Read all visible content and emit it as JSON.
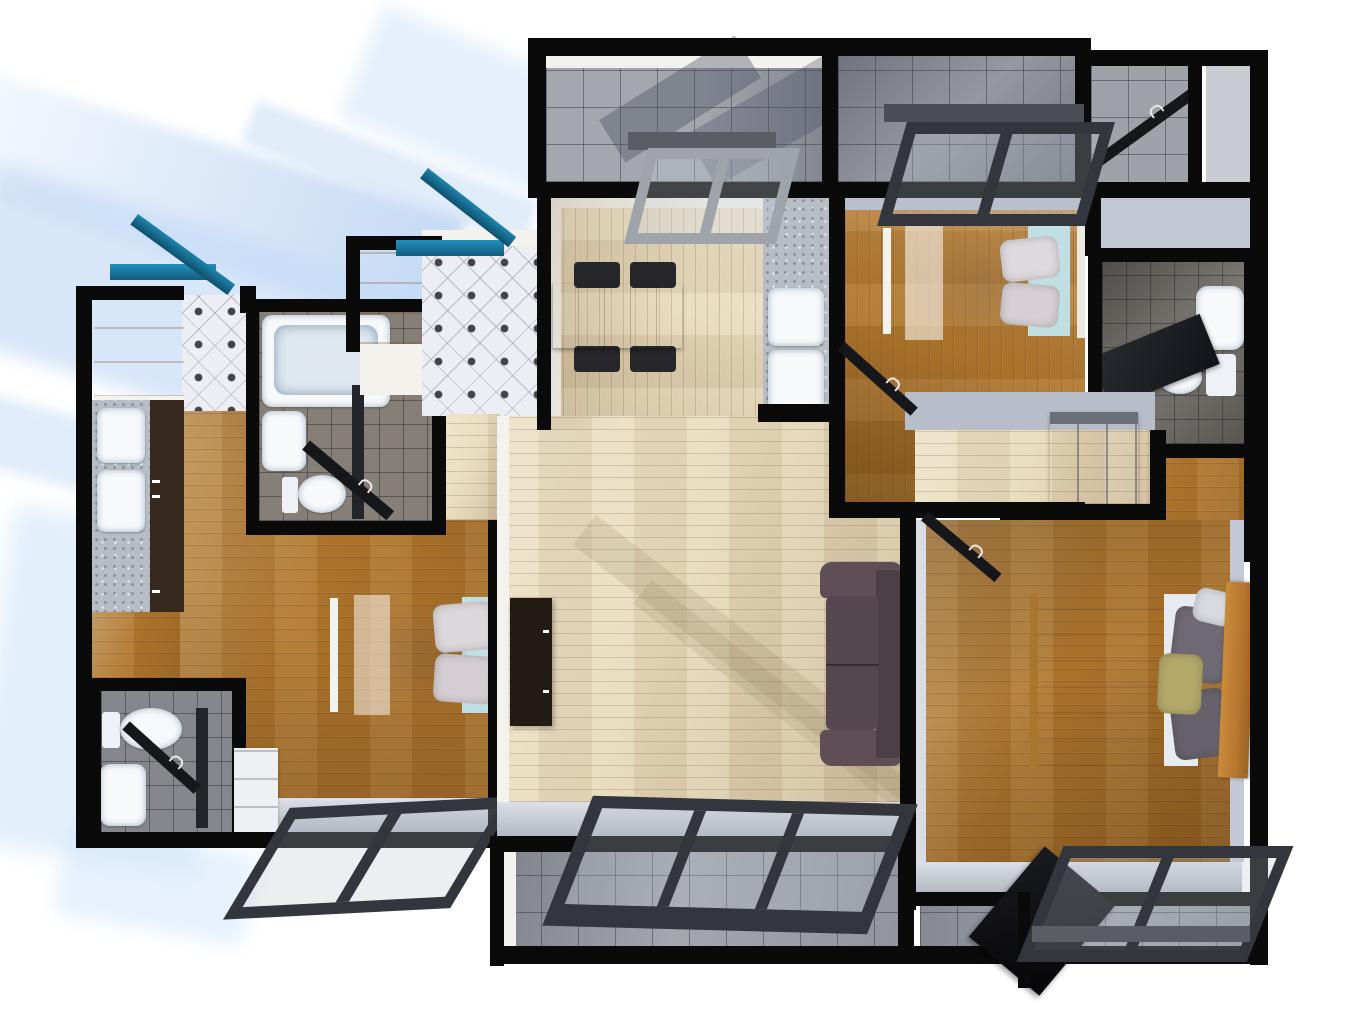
{
  "scene": {
    "type": "3d_floor_plan_render",
    "view": "top_down",
    "style": "photorealistic architectural render on white background with soft blue cast shadows falling to the lower-left",
    "units": [
      {
        "name": "Studio unit (left)",
        "rooms": [
          {
            "name": "Entry foyer",
            "floor": "white diamond tile",
            "items": [
              "teal entry door (open)",
              "wood wardrobe"
            ]
          },
          {
            "name": "Kitchenette",
            "floor": "hardwood",
            "items": [
              "stone counter",
              "double sink",
              "dark cabinet run"
            ]
          },
          {
            "name": "Bathroom",
            "floor": "gray tile",
            "items": [
              "bathtub",
              "wash basin",
              "toilet",
              "dark swing door (open)"
            ]
          },
          {
            "name": "Sleeping area",
            "floor": "hardwood",
            "items": [
              "single bed with blush bedding",
              "two gray pillows",
              "teal bed base"
            ]
          },
          {
            "name": "Water closet",
            "floor": "gray tile",
            "items": [
              "toilet",
              "wash basin",
              "white drawer unit",
              "dark swing door (open)"
            ]
          },
          {
            "name": "South window bay",
            "floor": "none",
            "items": [
              "detached dark window frame leaning outside the wall"
            ]
          }
        ]
      },
      {
        "name": "Main apartment (right)",
        "rooms": [
          {
            "name": "Entry foyer",
            "floor": "white diamond tile",
            "items": [
              "teal entry door (open)",
              "wood wardrobe"
            ]
          },
          {
            "name": "Dining room",
            "floor": "light hardwood",
            "items": [
              "rectangular wood dining table",
              "black chair x4"
            ]
          },
          {
            "name": "Kitchen",
            "floor": "light hardwood",
            "items": [
              "stone counter",
              "double sink"
            ]
          },
          {
            "name": "North balcony",
            "floor": "gray tile",
            "items": [
              "gray glass door leaning at opening"
            ]
          },
          {
            "name": "Utility balcony",
            "floor": "gray tile",
            "items": [
              "dark service door (open)"
            ]
          },
          {
            "name": "Bedroom 1",
            "floor": "hardwood",
            "items": [
              "bed with blush bedding",
              "two gray pillows",
              "teal base",
              "window frame leaning at balcony opening",
              "dark swing door (open)"
            ]
          },
          {
            "name": "Bathroom",
            "floor": "dark tile",
            "items": [
              "basin with counter",
              "toilet with tank",
              "dark swing door (open)"
            ]
          },
          {
            "name": "Walk-in closet",
            "floor": "hardwood",
            "items": [
              "white sliding door panel"
            ]
          },
          {
            "name": "Hallway",
            "floor": "light hardwood",
            "items": [
              "gray double wardrobe"
            ]
          },
          {
            "name": "Living room",
            "floor": "light hardwood",
            "items": [
              "dark two-seat sofa",
              "espresso TV console"
            ]
          },
          {
            "name": "Master bedroom",
            "floor": "hardwood",
            "items": [
              "double bed with yellow and gray striped duvet",
              "wood headboard",
              "two gray pillows",
              "olive pillow",
              "white pillow",
              "dark swing door (open)"
            ]
          },
          {
            "name": "South balconies",
            "floor": "gray tile",
            "items": [
              "three-pane window frame leaning at living room opening",
              "window frame leaning at master bedroom opening",
              "dark glass door (open)"
            ]
          }
        ]
      }
    ]
  },
  "palette": {
    "wall": "#0a0a0b",
    "facet": "#f3f2ec",
    "ledge": "#c5cbd6",
    "wood_light": "#e9dcbd",
    "wood_mid": "#b1782e",
    "tile_balcony": "#a4a7ad",
    "tile_bath": "#807b75",
    "diamond_base": "#edeef4",
    "diamond_dot": "#43444c",
    "marble": "#b7bcc5",
    "cabinet_dark": "#38291f",
    "console_dark": "#241a14",
    "wardrobe_orange": "#d98a33",
    "door_teal": "#1d84ad",
    "door_teal_dark": "#135d7d",
    "table_wood": "#a84e1f",
    "chair_black": "#27272b",
    "sofa_brown": "#554750",
    "bedding_blush": "#ecdcd5",
    "bed_base_teal": "#bfdfe3",
    "stripe_yellow": "#e2bf70",
    "stripe_gray": "#918e9b",
    "pillow_gray": "#6f6973",
    "pillow_olive": "#b3a76a",
    "headboard_wood": "#b5762f",
    "frame_dark": "#33363c",
    "frame_light": "#9fa3aa",
    "lintel_gray": "#5a5d63",
    "door_slab_dark": "#16171b",
    "fixture_white": "#f7f9fb",
    "shadow_blue": "#cfe0f4"
  }
}
